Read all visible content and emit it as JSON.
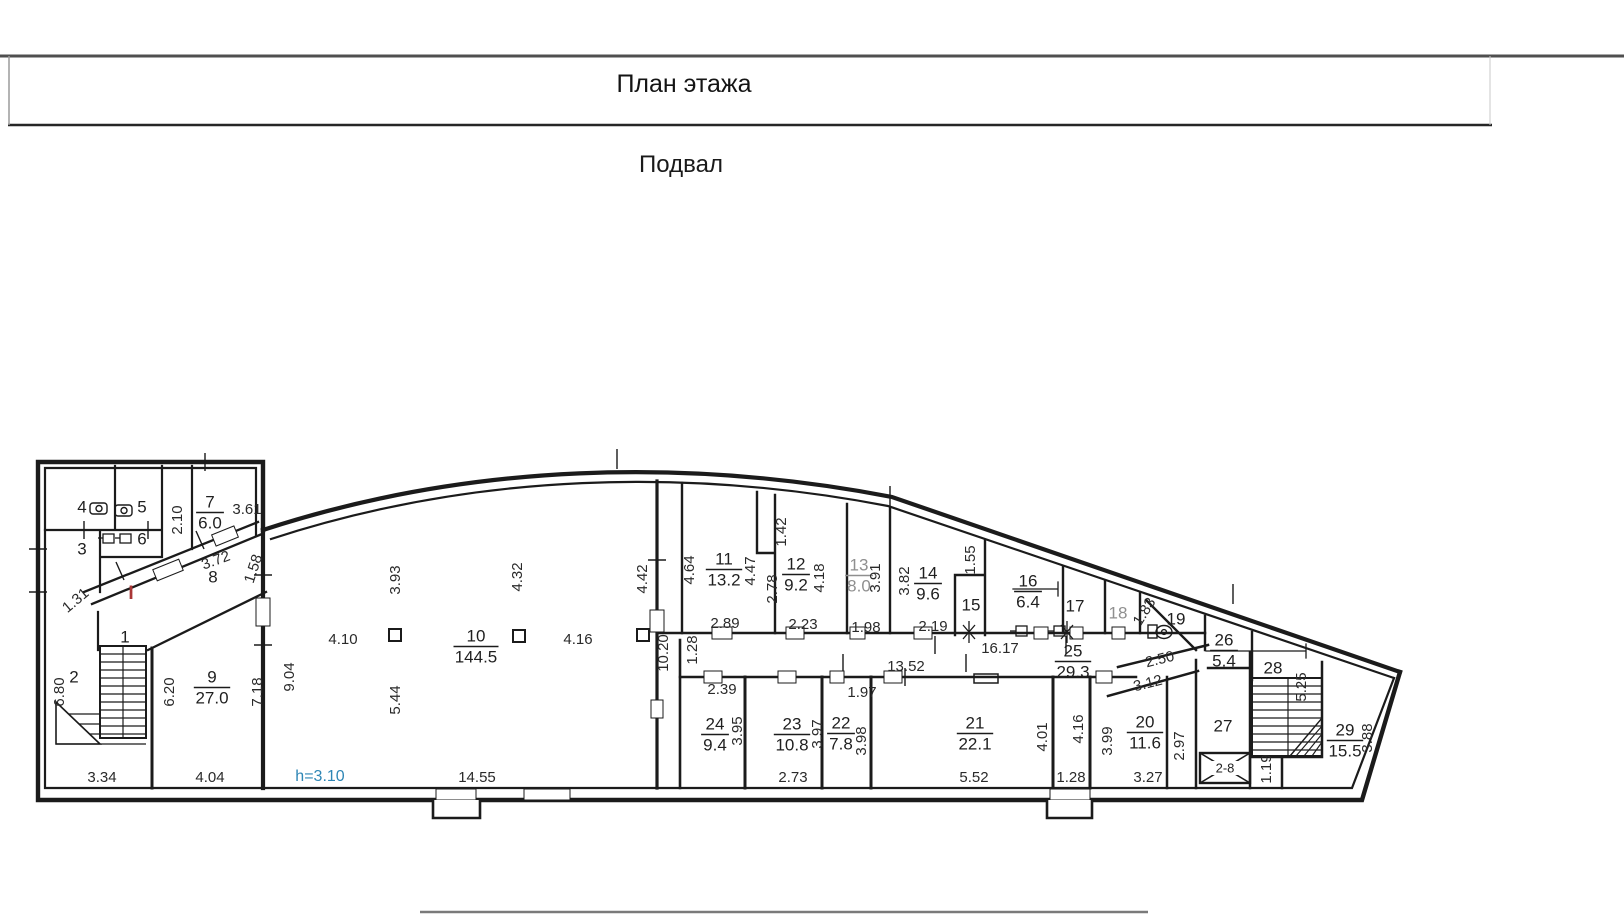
{
  "header": {
    "title": "План этажа",
    "subtitle": "Подвал"
  },
  "plan": {
    "colors": {
      "ink": "#1b1b1b",
      "height_note": "#2e86b5",
      "red_mark": "#a93636",
      "muted_label": "#8f8f8f"
    },
    "height_note": "h=3.10",
    "red_mark": "I",
    "elevator_label": "2-8",
    "rooms": [
      {
        "n": 1,
        "x": 125,
        "y": 638
      },
      {
        "n": 2,
        "x": 74,
        "y": 678
      },
      {
        "n": 3,
        "x": 82,
        "y": 550
      },
      {
        "n": 4,
        "x": 82,
        "y": 508
      },
      {
        "n": 5,
        "x": 142,
        "y": 508
      },
      {
        "n": 6,
        "x": 142,
        "y": 540
      },
      {
        "n": 7,
        "area": "6.0",
        "x": 210,
        "y": 503
      },
      {
        "n": 8,
        "x": 213,
        "y": 578
      },
      {
        "n": 9,
        "area": "27.0",
        "x": 212,
        "y": 678
      },
      {
        "n": 10,
        "area": "144.5",
        "x": 476,
        "y": 637
      },
      {
        "n": 11,
        "area": "13.2",
        "x": 724,
        "y": 560
      },
      {
        "n": 12,
        "area": "9.2",
        "x": 796,
        "y": 565
      },
      {
        "n": 13,
        "area": "8.0",
        "x": 859,
        "y": 566,
        "muted": true
      },
      {
        "n": 14,
        "area": "9.6",
        "x": 928,
        "y": 574
      },
      {
        "n": 15,
        "x": 971,
        "y": 606
      },
      {
        "n": 16,
        "area": "6.4",
        "x": 1028,
        "y": 582
      },
      {
        "n": 17,
        "x": 1075,
        "y": 607
      },
      {
        "n": 18,
        "x": 1118,
        "y": 614,
        "muted": true
      },
      {
        "n": 19,
        "x": 1176,
        "y": 620
      },
      {
        "n": 20,
        "area": "11.6",
        "x": 1145,
        "y": 723
      },
      {
        "n": 21,
        "area": "22.1",
        "x": 975,
        "y": 724
      },
      {
        "n": 22,
        "area": "7.8",
        "x": 841,
        "y": 724
      },
      {
        "n": 23,
        "area": "10.8",
        "x": 792,
        "y": 725
      },
      {
        "n": 24,
        "area": "9.4",
        "x": 715,
        "y": 725
      },
      {
        "n": 25,
        "area": "29.3",
        "x": 1073,
        "y": 652
      },
      {
        "n": 26,
        "area": "5.4",
        "x": 1224,
        "y": 641
      },
      {
        "n": 27,
        "x": 1223,
        "y": 727
      },
      {
        "n": 28,
        "x": 1273,
        "y": 669
      },
      {
        "n": 29,
        "area": "15.5",
        "x": 1345,
        "y": 731
      }
    ],
    "dimensions": [
      {
        "t": "3.61",
        "x": 247,
        "y": 510
      },
      {
        "t": "2.10",
        "x": 178,
        "y": 520,
        "r": -90
      },
      {
        "t": "3.72",
        "x": 216,
        "y": 561,
        "r": -20
      },
      {
        "t": "1.58",
        "x": 254,
        "y": 569,
        "r": -72
      },
      {
        "t": "1.31",
        "x": 76,
        "y": 601,
        "r": -40
      },
      {
        "t": "6.80",
        "x": 60,
        "y": 692,
        "r": -90
      },
      {
        "t": "6.20",
        "x": 170,
        "y": 692,
        "r": -90
      },
      {
        "t": "7.18",
        "x": 258,
        "y": 692,
        "r": -90
      },
      {
        "t": "3.34",
        "x": 102,
        "y": 778
      },
      {
        "t": "4.04",
        "x": 210,
        "y": 778
      },
      {
        "t": "9.04",
        "x": 290,
        "y": 677,
        "r": -90
      },
      {
        "t": "4.10",
        "x": 343,
        "y": 640
      },
      {
        "t": "3.93",
        "x": 396,
        "y": 580,
        "r": -90
      },
      {
        "t": "5.44",
        "x": 396,
        "y": 700,
        "r": -90
      },
      {
        "t": "4.32",
        "x": 518,
        "y": 577,
        "r": -90
      },
      {
        "t": "4.16",
        "x": 578,
        "y": 640
      },
      {
        "t": "4.42",
        "x": 643,
        "y": 579,
        "r": -90
      },
      {
        "t": "14.55",
        "x": 477,
        "y": 778
      },
      {
        "t": "10.20",
        "x": 664,
        "y": 653,
        "r": -90
      },
      {
        "t": "1.28",
        "x": 693,
        "y": 650,
        "r": -90
      },
      {
        "t": "4.64",
        "x": 690,
        "y": 570,
        "r": -90
      },
      {
        "t": "4.47",
        "x": 751,
        "y": 571,
        "r": -90
      },
      {
        "t": "2.89",
        "x": 725,
        "y": 624
      },
      {
        "t": "1.42",
        "x": 782,
        "y": 532,
        "r": -90
      },
      {
        "t": "2.78",
        "x": 773,
        "y": 589,
        "r": -90
      },
      {
        "t": "4.18",
        "x": 820,
        "y": 578,
        "r": -90
      },
      {
        "t": "2.23",
        "x": 803,
        "y": 625
      },
      {
        "t": "3.91",
        "x": 876,
        "y": 578,
        "r": -90
      },
      {
        "t": "1.98",
        "x": 866,
        "y": 628
      },
      {
        "t": "3.82",
        "x": 905,
        "y": 581,
        "r": -90
      },
      {
        "t": "1.55",
        "x": 971,
        "y": 560,
        "r": -90
      },
      {
        "t": "2.19",
        "x": 933,
        "y": 627
      },
      {
        "t": "16.17",
        "x": 1000,
        "y": 649
      },
      {
        "t": "13.52",
        "x": 906,
        "y": 667
      },
      {
        "t": "1.83",
        "x": 1145,
        "y": 612,
        "r": -58
      },
      {
        "t": "2.50",
        "x": 1160,
        "y": 660,
        "r": -14
      },
      {
        "t": "3.12",
        "x": 1148,
        "y": 684,
        "r": -14
      },
      {
        "t": "2.39",
        "x": 722,
        "y": 690
      },
      {
        "t": "3.95",
        "x": 738,
        "y": 731,
        "r": -90
      },
      {
        "t": "3.97",
        "x": 818,
        "y": 734,
        "r": -90
      },
      {
        "t": "2.73",
        "x": 793,
        "y": 778
      },
      {
        "t": "1.97",
        "x": 862,
        "y": 693
      },
      {
        "t": "3.98",
        "x": 862,
        "y": 741,
        "r": -90
      },
      {
        "t": "5.52",
        "x": 974,
        "y": 778
      },
      {
        "t": "4.01",
        "x": 1043,
        "y": 737,
        "r": -90
      },
      {
        "t": "1.28",
        "x": 1071,
        "y": 778
      },
      {
        "t": "4.16",
        "x": 1079,
        "y": 729,
        "r": -90
      },
      {
        "t": "3.99",
        "x": 1108,
        "y": 741,
        "r": -90
      },
      {
        "t": "2.97",
        "x": 1180,
        "y": 746,
        "r": -90
      },
      {
        "t": "3.27",
        "x": 1148,
        "y": 778
      },
      {
        "t": "5.25",
        "x": 1302,
        "y": 687,
        "r": -90
      },
      {
        "t": "1.19",
        "x": 1267,
        "y": 769,
        "r": -90
      },
      {
        "t": "3.88",
        "x": 1368,
        "y": 738,
        "r": -90
      }
    ]
  }
}
